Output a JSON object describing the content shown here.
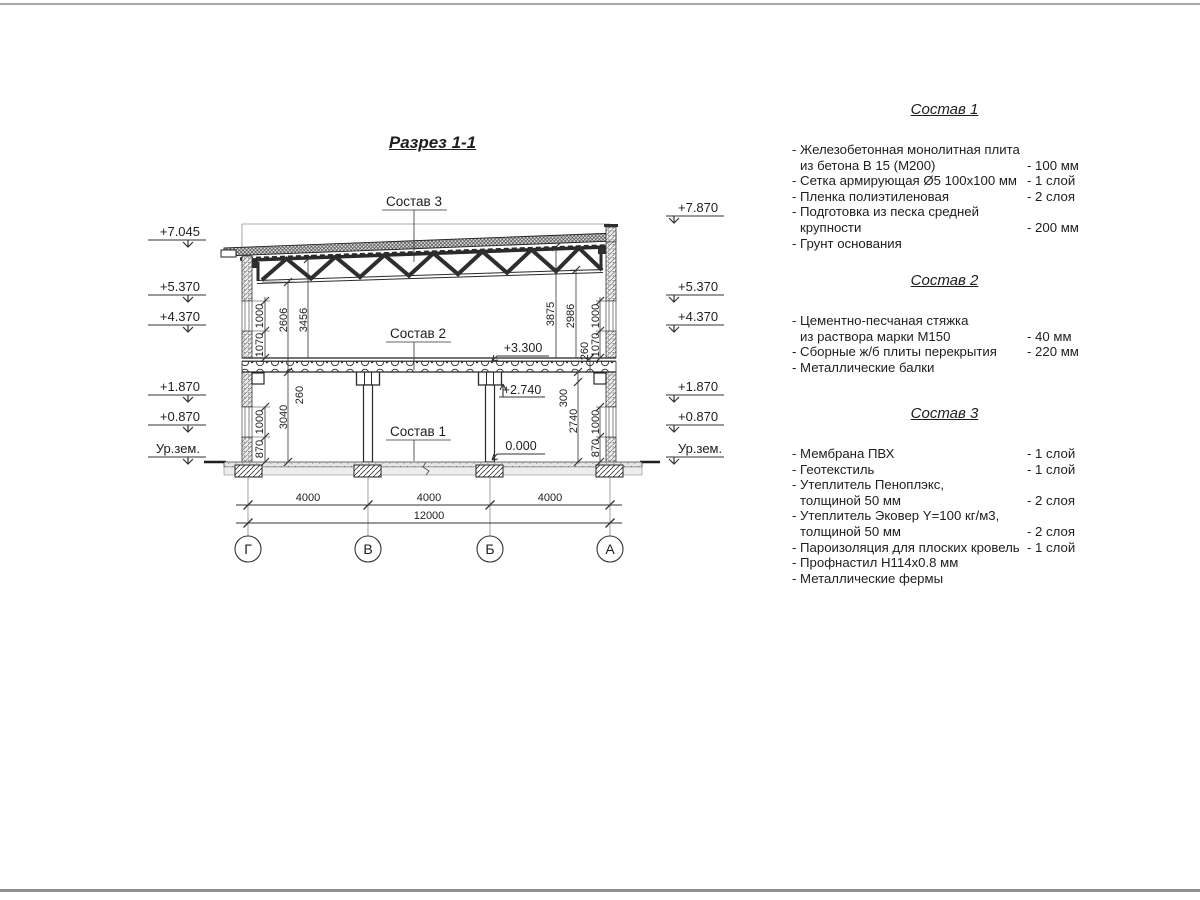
{
  "page": {
    "title": "Разрез 1-1"
  },
  "drawing": {
    "callouts": {
      "sostav1": "Состав 1",
      "sostav2": "Состав 2",
      "sostav3": "Состав 3"
    },
    "levels": {
      "l3300": "+3.300",
      "l2740": "+2.740",
      "l0000": "0.000"
    },
    "elev_left": [
      "+7.045",
      "+5.370",
      "+4.370",
      "+1.870",
      "+0.870",
      "Ур.зем."
    ],
    "elev_right": [
      "+7.870",
      "+5.370",
      "+4.370",
      "+1.870",
      "+0.870",
      "Ур.зем."
    ],
    "dims": {
      "left": {
        "c1000u": "1000",
        "c1070": "1070",
        "d2606": "2606",
        "d3456": "3456",
        "d260": "260",
        "d3040": "3040",
        "c1000l": "1000",
        "c870": "870"
      },
      "right": {
        "d3875": "3875",
        "d2986": "2986",
        "d260": "260",
        "c1000u": "1000",
        "c1070": "1070",
        "d300": "300",
        "d2740": "2740",
        "c1000l": "1000",
        "c870": "870"
      },
      "bottom": {
        "span1": "4000",
        "span2": "4000",
        "span3": "4000",
        "total": "12000"
      }
    },
    "axes": [
      "Г",
      "В",
      "Б",
      "А"
    ]
  },
  "compositions": [
    {
      "title": "Состав 1",
      "items": [
        {
          "l1": "- Железобетонная  монолитная плита",
          "l2": "из бетона В 15 (М200)",
          "val": "- 100 мм"
        },
        {
          "l1": "- Сетка армирующая Ø5 100х100 мм",
          "val": "- 1 слой"
        },
        {
          "l1": "- Пленка полиэтиленовая",
          "val": "- 2 слоя"
        },
        {
          "l1": "- Подготовка из песка средней",
          "l2": "крупности",
          "val": "- 200 мм"
        },
        {
          "l1": "- Грунт основания"
        }
      ]
    },
    {
      "title": "Состав 2",
      "items": [
        {
          "l1": "- Цементно-песчаная стяжка",
          "l2": "из раствора марки М150",
          "val": "- 40 мм"
        },
        {
          "l1": "- Сборные ж/б плиты перекрытия",
          "val": "- 220 мм"
        },
        {
          "l1": "- Металлические балки"
        }
      ]
    },
    {
      "title": "Состав 3",
      "items": [
        {
          "l1": "- Мембрана ПВХ",
          "val": "- 1 слой"
        },
        {
          "l1": "- Геотекстиль",
          "val": "- 1 слой"
        },
        {
          "l1": "- Утеплитель Пеноплэкс,",
          "l2": "толщиной 50 мм",
          "val": "- 2 слоя"
        },
        {
          "l1": "- Утеплитель Эковер Y=100 кг/м3,",
          "l2": "толщиной 50 мм",
          "val": "- 2 слоя"
        },
        {
          "l1": "- Пароизоляция для плоских кровель",
          "val": "- 1 слой"
        },
        {
          "l1": "- Профнастил Н114х0.8 мм"
        },
        {
          "l1": "- Металлические фермы"
        }
      ]
    }
  ]
}
